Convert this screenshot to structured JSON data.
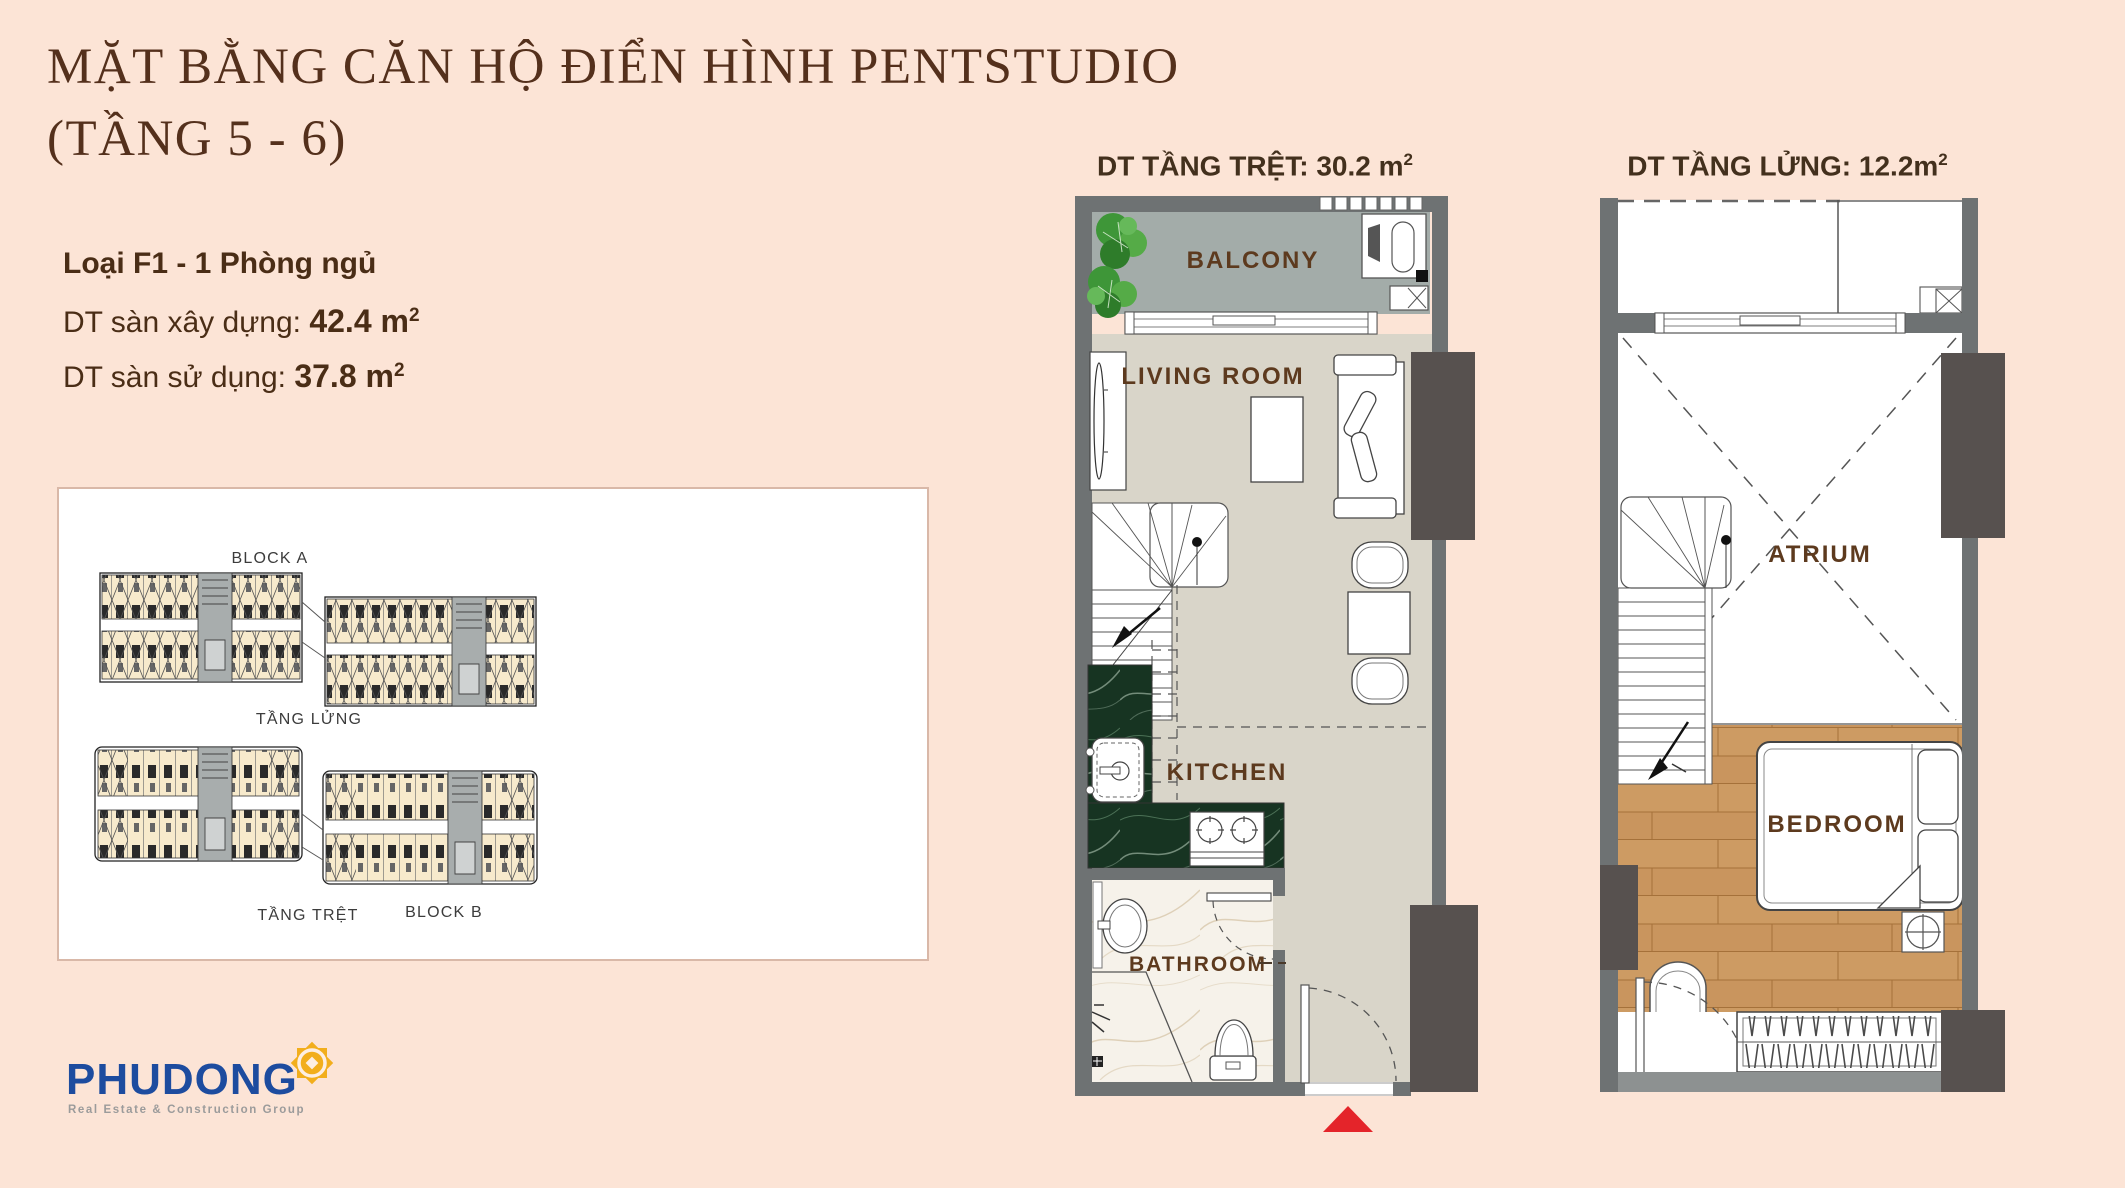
{
  "header": {
    "title_line1": "MẶT BẰNG CĂN HỘ ĐIỂN HÌNH PENTSTUDIO",
    "title_line2": "(TẦNG 5 - 6)",
    "unit_type": "Loại F1 - 1 Phòng ngủ",
    "built_area": {
      "label": "DT sàn xây dựng:",
      "value": "42.4 m",
      "sup": "2"
    },
    "usable_area": {
      "label": "DT sàn sử dụng:",
      "value": "37.8 m",
      "sup": "2"
    }
  },
  "block_panel": {
    "block_a_label": "BLOCK A",
    "block_b_label": "BLOCK B",
    "mezzanine_label": "TẦNG LỬNG",
    "ground_label": "TẦNG TRỆT"
  },
  "ground_plan": {
    "title_label": "DT TẦNG TRỆT:",
    "title_value": "30.2 m",
    "title_sup": "2",
    "rooms": {
      "balcony": "BALCONY",
      "living_room": "LIVING ROOM",
      "kitchen": "KITCHEN",
      "bathroom": "BATHROOM"
    }
  },
  "mezzanine_plan": {
    "title_label": "DT TẦNG LỬNG:",
    "title_value": "12.2m",
    "title_sup": "2",
    "rooms": {
      "atrium": "ATRIUM",
      "bedroom": "BEDROOM"
    }
  },
  "logo": {
    "name": "PHUDONG",
    "tagline": "Real Estate & Construction Group"
  },
  "colors": {
    "background": "#fce4d6",
    "title_brown": "#54301c",
    "wall_gray": "#6e7273",
    "column_dark": "#57514f",
    "balcony_floor": "#a3aca9",
    "living_floor": "#d9d5c9",
    "marble_green": "#173422",
    "wood": "#c9955e",
    "entrance_arrow_red": "#e4242a",
    "logo_blue": "#1d4c9f",
    "logo_yellow": "#f2ae1c"
  }
}
